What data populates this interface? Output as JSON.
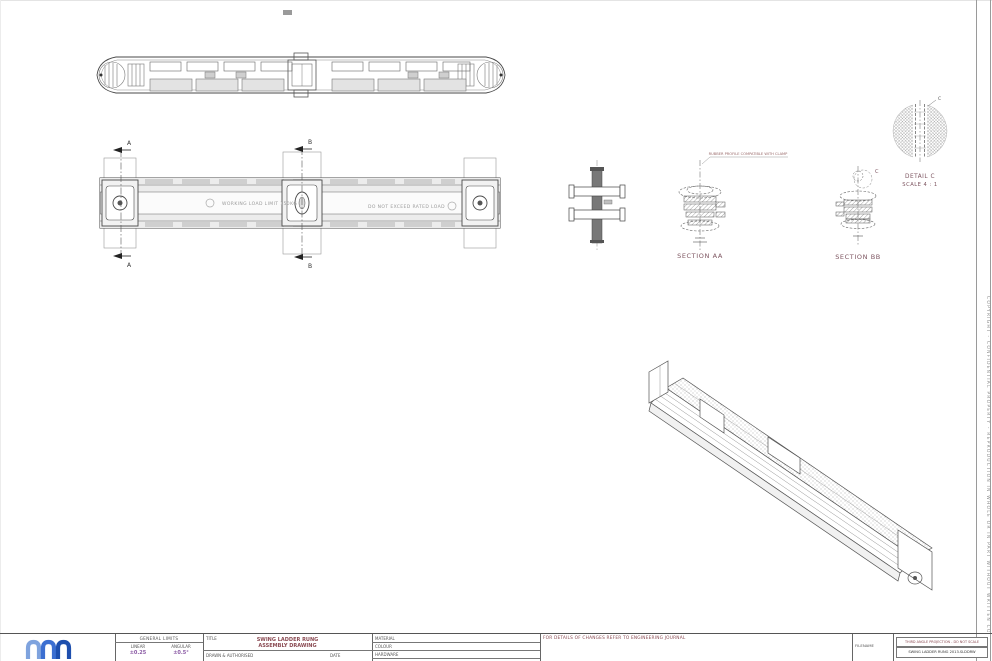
{
  "sheet": {
    "side_notice": "COPYRIGHT - CONFIDENTIAL PROPERTY - REPRODUCTION IN WHOLE OR IN PART WITHOUT WRITTEN CONSENT IS PROHIBITED"
  },
  "views": {
    "front_view": {
      "section_a": "A",
      "section_b": "B",
      "engraved_left": "WORKING LOAD LIMIT 150KG",
      "engraved_right": "DO NOT EXCEED RATED LOAD"
    },
    "section_aa": {
      "label": "SECTION AA",
      "note": "RUBBER PROFILE COMPATIBLE WITH CLAMP"
    },
    "section_bb": {
      "label": "SECTION BB",
      "marker": "C"
    },
    "detail_c": {
      "label": "DETAIL C",
      "scale": "SCALE 4 : 1",
      "marker": "C"
    }
  },
  "title_block": {
    "general_limits": {
      "header": "GENERAL LIMITS",
      "linear_label": "LINEAR",
      "linear_value": "±0.25",
      "angular_label": "ANGULAR",
      "angular_value": "±0.5°"
    },
    "title": {
      "label": "TITLE",
      "line1": "SWING LADDER RUNG",
      "line2": "ASSEMBLY DRAWING",
      "drawn_label": "DRAWN & AUTHORISED",
      "date_label": "DATE"
    },
    "material": {
      "material_label": "MATERIAL",
      "colour_label": "COLOUR",
      "hardware_label": "HARDWARE"
    },
    "changes_note": "FOR DETAILS OF CHANGES REFER TO ENGINEERING JOURNAL",
    "filename_label": "FILENAME",
    "projection_note": "THIRD ANGLE PROJECTION - DO NOT SCALE",
    "filename_value": "SWING LADDER RUNG 2013.SLDDRW"
  },
  "colors": {
    "line": "#4a4a4a",
    "accent_maroon": "#8a4a52",
    "accent_purple": "#8b5ba5",
    "logo_blue_light": "#7fa3de",
    "logo_blue_mid": "#3c6fd1",
    "logo_blue_dark": "#1e4fae"
  }
}
